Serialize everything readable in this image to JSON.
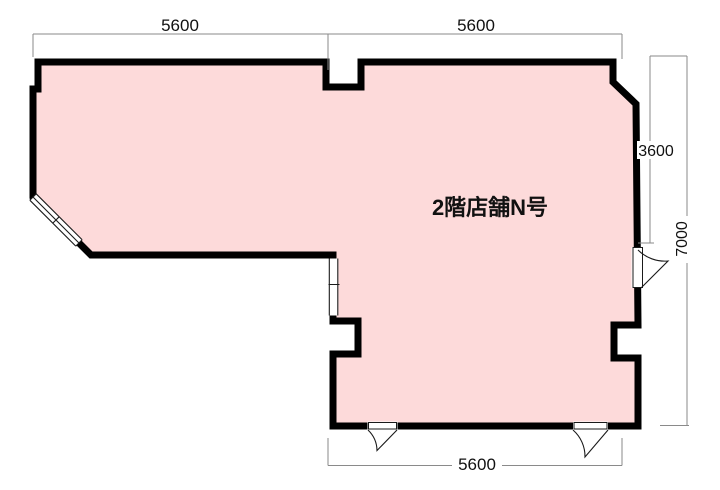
{
  "floor_plan": {
    "unit_label": "2階店舗N号",
    "dimensions": {
      "top_left": "5600",
      "top_right": "5600",
      "right_upper": "3600",
      "right_full": "7000",
      "bottom": "5600"
    },
    "colors": {
      "room_fill": "#fddada",
      "wall": "#000000",
      "dimension_line": "#8a8a8a",
      "background": "#ffffff"
    }
  }
}
